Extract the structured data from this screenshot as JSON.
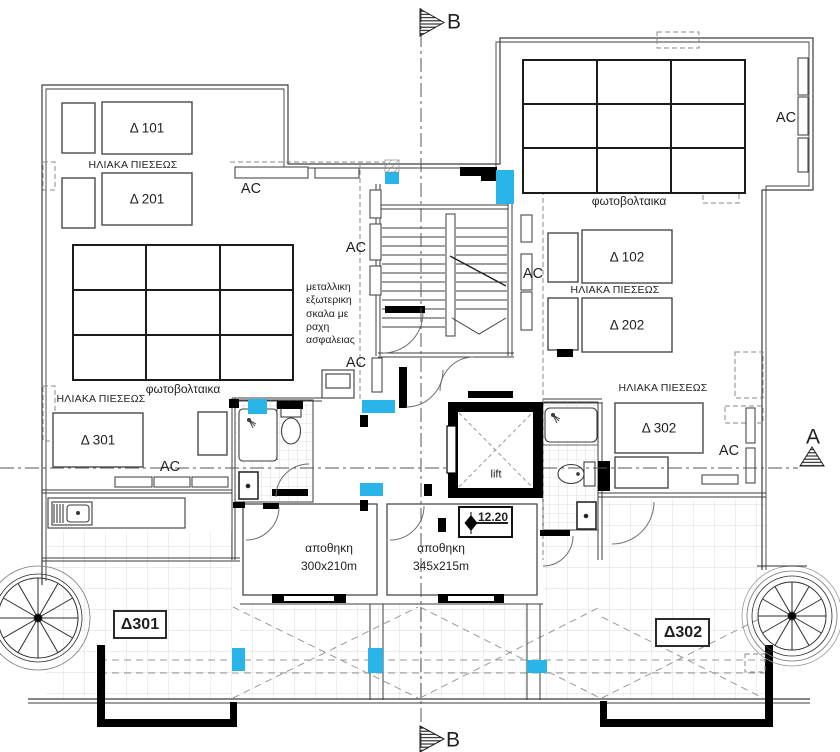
{
  "plan": {
    "markers": {
      "b_top": "B",
      "b_bottom": "B",
      "a_right": "A"
    },
    "units": {
      "d101": "Δ 101",
      "d201": "Δ 201",
      "d102": "Δ 102",
      "d202": "Δ 202",
      "d301": "Δ 301",
      "d302": "Δ 302"
    },
    "equipment": {
      "solar_top_left": "ΗΛΙΑΚΑ ΠΙΕΣΕΩΣ",
      "solar_left": "ΗΛΙΑΚΑ ΠΙΕΣΕΩΣ",
      "solar_right_upper": "ΗΛΙΑΚΑ ΠΙΕΣΕΩΣ",
      "solar_right_lower": "ΗΛΙΑΚΑ ΠΙΕΣΕΩΣ",
      "pv_left": "φωτοβολταικα",
      "pv_right": "φωτοβολταικα",
      "ac": [
        "AC",
        "AC",
        "AC",
        "AC",
        "AC",
        "AC",
        "AC"
      ]
    },
    "rooms": {
      "lift": "lift",
      "storage_left": {
        "name": "αποθηκη",
        "size": "300x210m"
      },
      "storage_right": {
        "name": "αποθηκη",
        "size": "345x215m"
      }
    },
    "terraces": {
      "left": "Δ301",
      "right": "Δ302"
    },
    "levels": {
      "roof": "12.20"
    },
    "notes": {
      "stair": "μεταλλικη\nεξωτερικη\nσκαλα με\nραχη\nασφαλειας"
    },
    "colors": {
      "column_highlight": "#29b4ea",
      "wall_fill": "#000000",
      "line": "#3d3d3d",
      "tile_grid": "#cfcfcf",
      "dashed": "#8a8a8a"
    }
  }
}
